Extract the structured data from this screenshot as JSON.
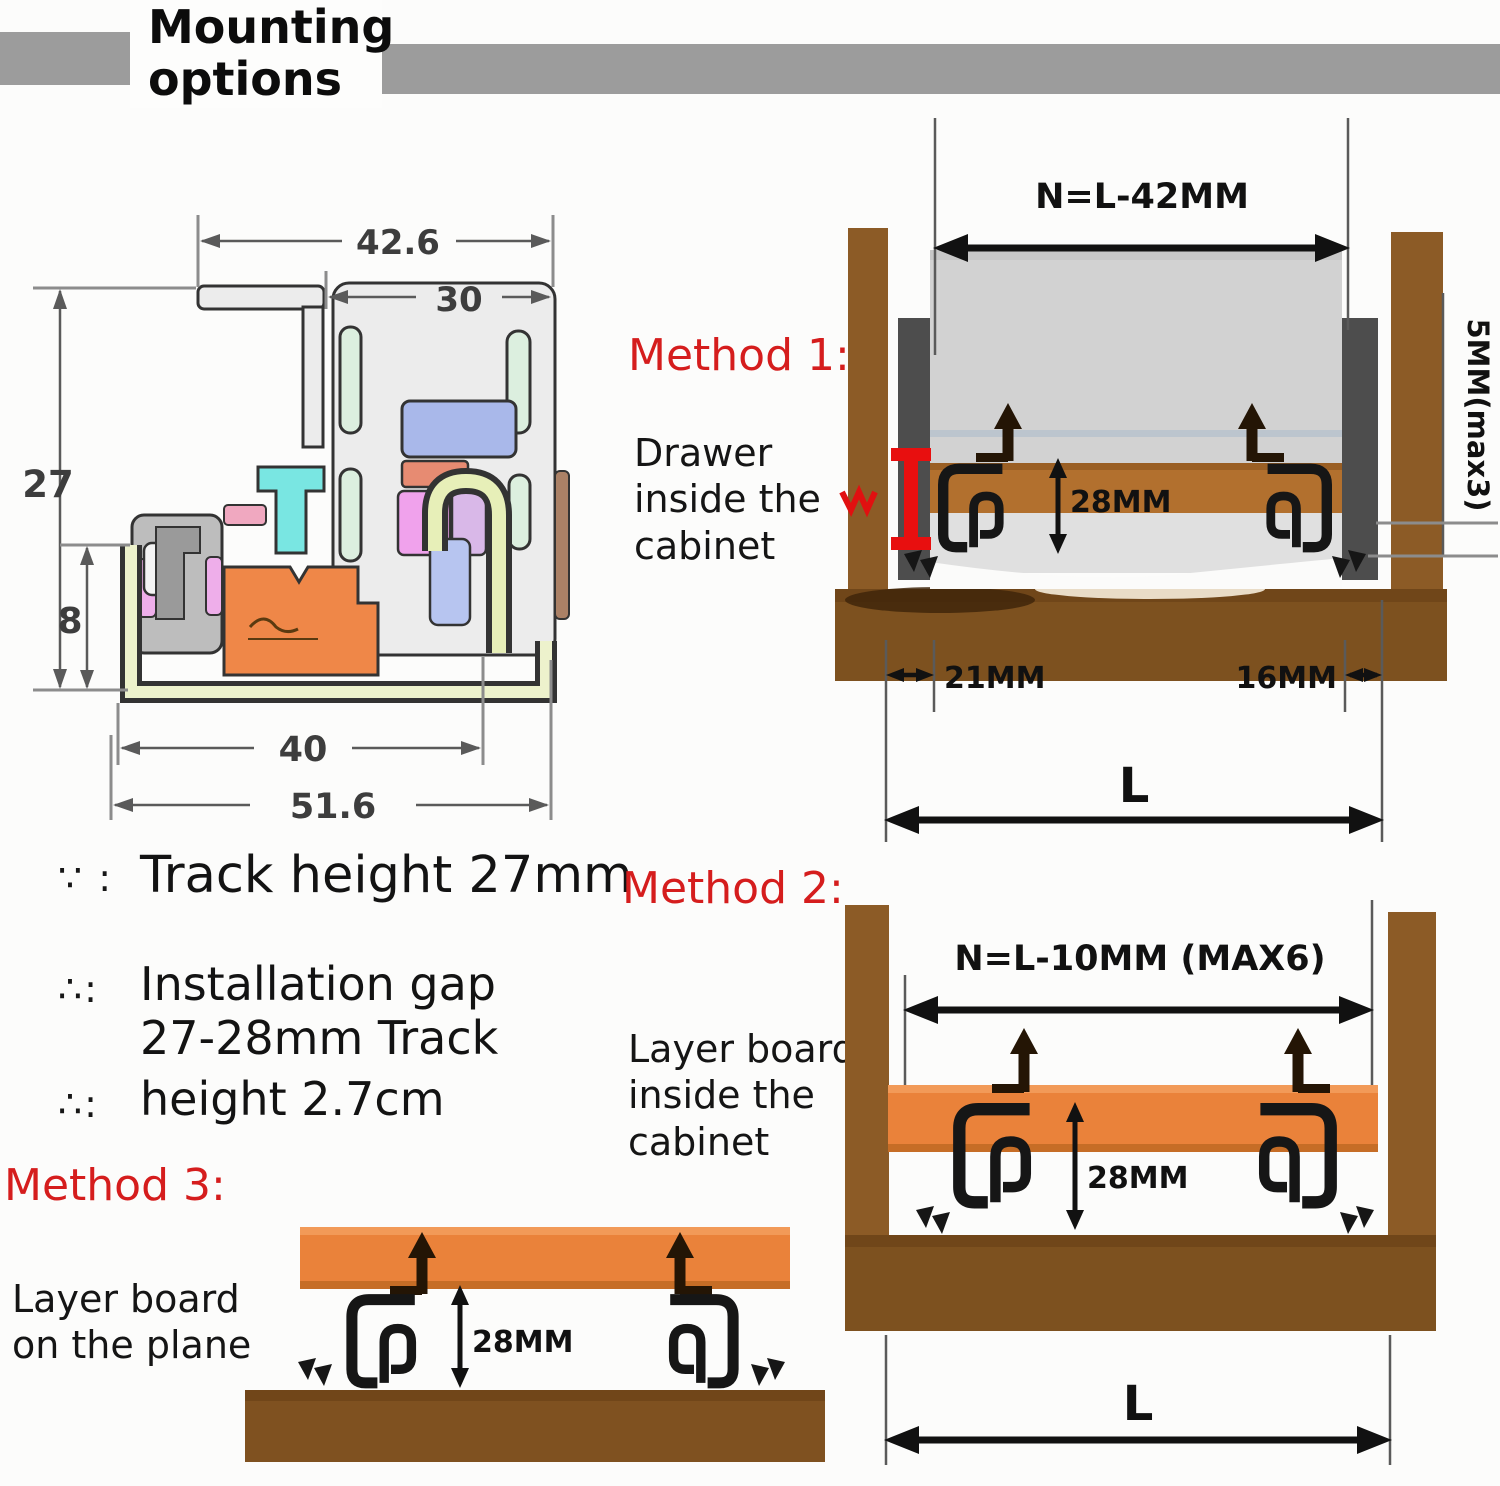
{
  "header": {
    "title": "Mounting options"
  },
  "cross_section": {
    "width_top": "42.6",
    "width_inner": "30",
    "height_total": "27",
    "height_lower": "8",
    "width_body": "40",
    "width_total": "51.6"
  },
  "method1": {
    "label": "Method 1:",
    "desc": "Drawer inside the cabinet",
    "dim_top": "N=L-42MM",
    "dim_side": "5MM(max3)",
    "dim_height": "28MM",
    "dim_left": "21MM",
    "dim_right": "16MM",
    "dim_length": "L"
  },
  "method2": {
    "label": "Method 2:",
    "desc": "Layer board inside the cabinet",
    "dim_top": "N=L-10MM (MAX6)",
    "dim_height": "28MM",
    "dim_length": "L"
  },
  "method3": {
    "label": "Method 3:",
    "desc": "Layer board on the plane",
    "dim_height": "28MM"
  },
  "notes": {
    "s1": "∵ :",
    "t1": "Track height 27mm",
    "s2": "∴:",
    "t2": "Installation gap 27-28mm Track",
    "s3": "∴:",
    "t3": "height 2.7cm"
  },
  "colors": {
    "accent_red": "#d51d1d",
    "wood": "#8c5b26",
    "wood_dark": "#7d511f",
    "board_orange": "#ea823a",
    "board_brown": "#b2702e",
    "drawer_gray": "#d2d2d2",
    "slide_gray": "#4d4d4d",
    "bar_gray": "#9c9c9c"
  }
}
